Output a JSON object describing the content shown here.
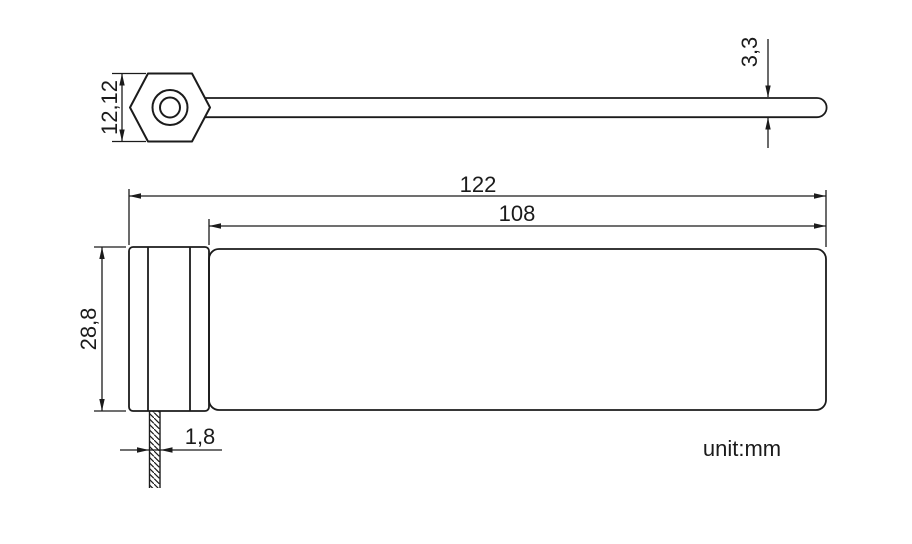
{
  "title": "security-seal-technical-drawing",
  "unit_label": "unit:mm",
  "colors": {
    "line": "#1b1b1b",
    "background": "#ffffff"
  },
  "dimensions": {
    "head_height": "12,12",
    "strap_thickness": "3,3",
    "total_length": "122",
    "strap_length": "108",
    "body_height": "28,8",
    "tail_width": "1,8"
  }
}
